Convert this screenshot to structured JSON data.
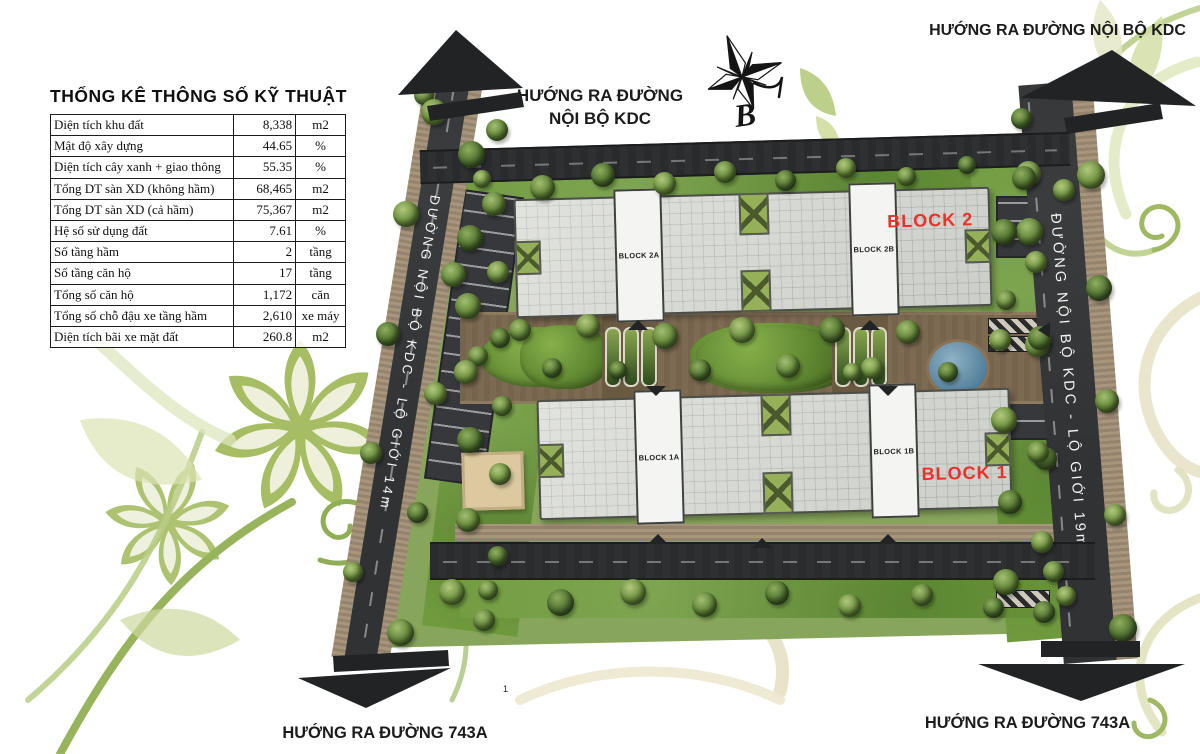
{
  "page": {
    "marker": "1"
  },
  "stats": {
    "title": "THỐNG KÊ THÔNG SỐ KỸ THUẬT",
    "rows": [
      {
        "label": "Diện tích khu đất",
        "value": "8,338",
        "unit": "m2"
      },
      {
        "label": "Mật độ xây dựng",
        "value": "44.65",
        "unit": "%"
      },
      {
        "label": "Diện tích cây xanh + giao thông",
        "value": "55.35",
        "unit": "%"
      },
      {
        "label": "Tổng DT sàn XD (không hầm)",
        "value": "68,465",
        "unit": "m2"
      },
      {
        "label": "Tổng DT sàn XD (cả hầm)",
        "value": "75,367",
        "unit": "m2"
      },
      {
        "label": "Hệ số sử dụng đất",
        "value": "7.61",
        "unit": "%"
      },
      {
        "label": "Số tầng hầm",
        "value": "2",
        "unit": "tầng"
      },
      {
        "label": "Số tầng căn hộ",
        "value": "17",
        "unit": "tầng"
      },
      {
        "label": "Tổng số căn hộ",
        "value": "1,172",
        "unit": "căn"
      },
      {
        "label": "Tổng số chỗ đậu xe tầng hầm",
        "value": "2,610",
        "unit": "xe máy"
      },
      {
        "label": "Diện tích bãi xe mặt đất",
        "value": "260.8",
        "unit": "m2"
      }
    ]
  },
  "directions": {
    "top_center_line1": "HƯỚNG RA ĐƯỜNG",
    "top_center_line2": "NỘI BỘ KDC",
    "top_right": "HƯỚNG RA ĐƯỜNG NỘI BỘ KDC",
    "bottom_left": "HƯỚNG RA ĐƯỜNG 743A",
    "bottom_right": "HƯỚNG RA ĐƯỜNG 743A"
  },
  "roads": {
    "left_label": "ĐƯỜNG NỘI BỘ KDC - LỘ GIỚI 14m",
    "right_label": "ĐƯỜNG NỘI BỘ KDC - LỘ GIỚI 19m"
  },
  "blocks": {
    "block2": {
      "label": "BLOCK 2",
      "core_a": "BLOCK 2A",
      "core_b": "BLOCK 2B"
    },
    "block1": {
      "label": "BLOCK 1",
      "core_a": "BLOCK 1A",
      "core_b": "BLOCK 1B"
    }
  },
  "compass": {
    "north_label": "B"
  },
  "colors": {
    "accent_red": "#e8322b",
    "road_dark": "#303234",
    "sidewalk_tan": "#a8957c",
    "lawn_green": "#6f9a3d",
    "roof_gray": "#d7d9d4"
  }
}
